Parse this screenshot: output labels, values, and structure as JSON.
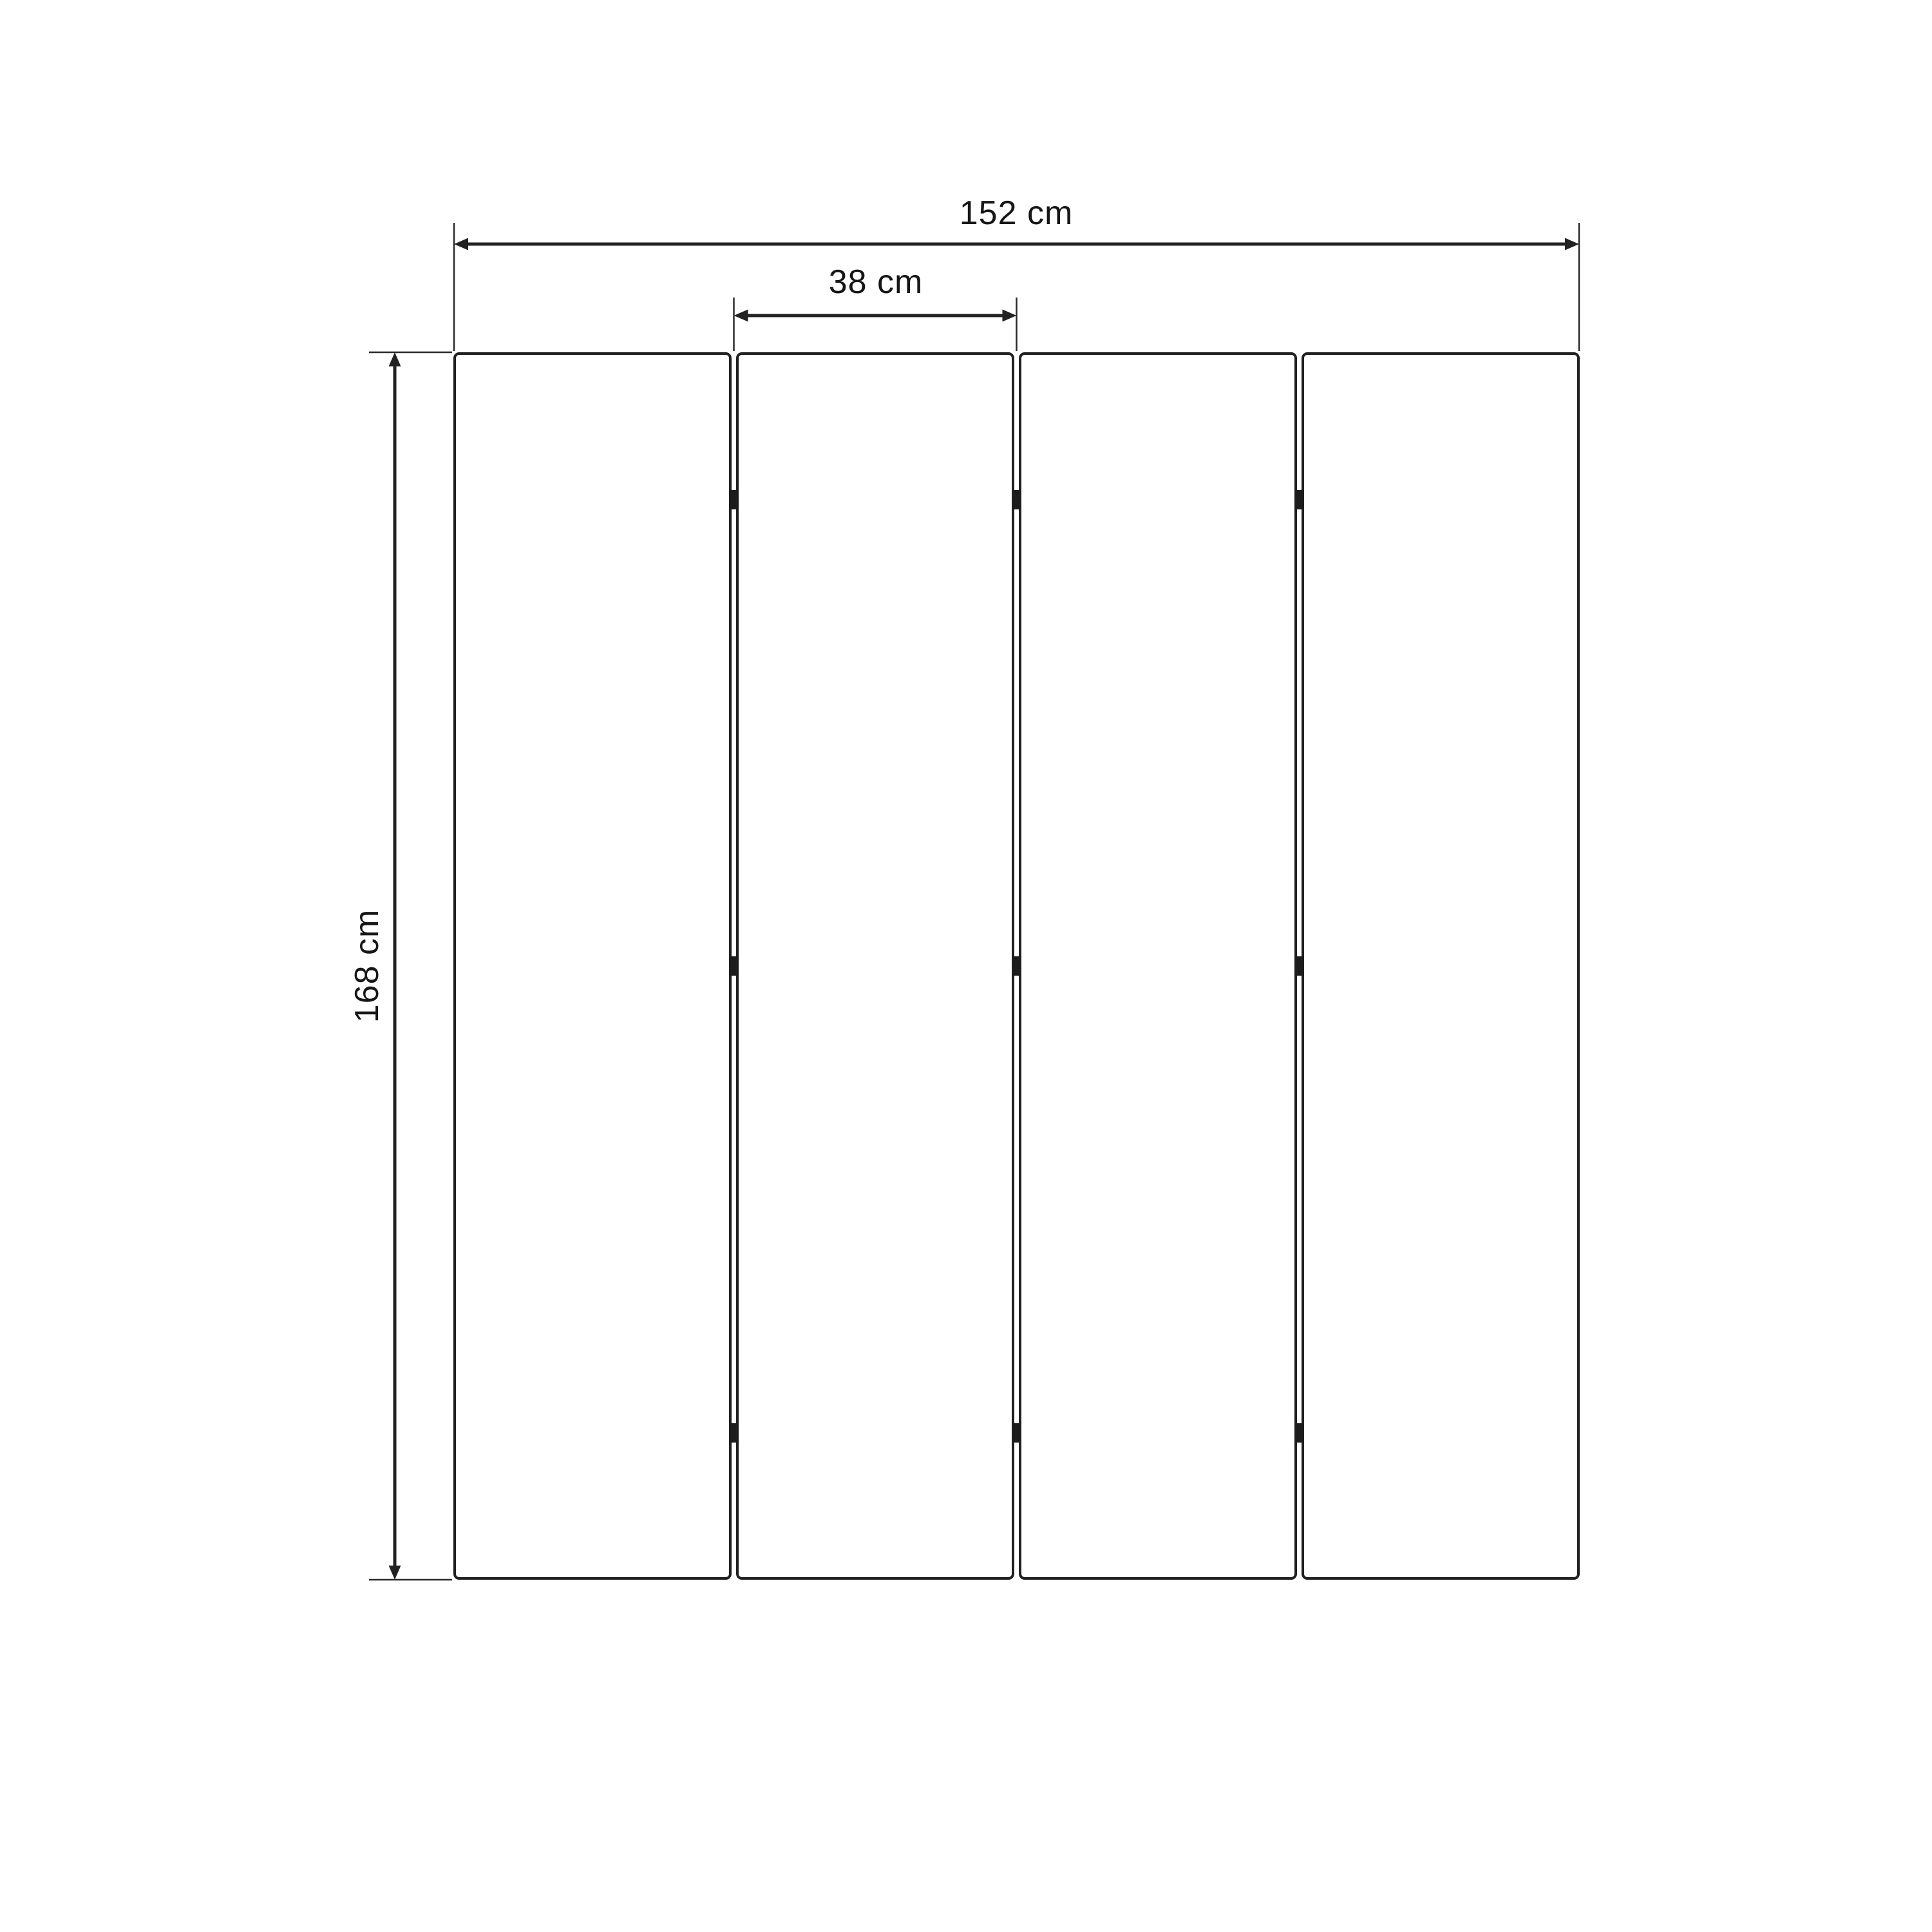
{
  "drawing": {
    "type": "technical-dimension-drawing",
    "subject": "four-panel folding screen, front elevation",
    "labels": {
      "total_width": "152 cm",
      "panel_width": "38 cm",
      "height": "168 cm"
    },
    "dimensions": {
      "total_width_cm": 152,
      "panel_width_cm": 38,
      "height_cm": 168
    },
    "panel_count": 4,
    "hinge_marks_per_gap": 3,
    "colors": {
      "line": "#222222",
      "text": "#161616",
      "background": "#ffffff"
    }
  }
}
